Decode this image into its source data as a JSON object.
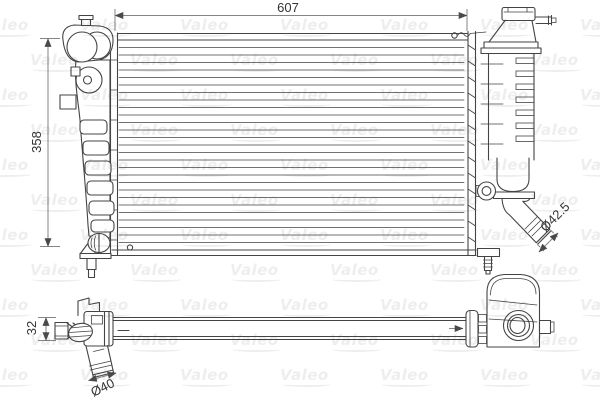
{
  "watermark": {
    "text": "Valeo"
  },
  "front_view": {
    "dimensions": {
      "width": {
        "label": "607"
      },
      "height": {
        "label": "358"
      },
      "outlet_diameter": {
        "label": "Ø42.5"
      }
    }
  },
  "bottom_view": {
    "dimensions": {
      "depth": {
        "label": "32"
      },
      "pipe_diameter": {
        "label": "Ø40"
      }
    }
  },
  "colors": {
    "background": "#ffffff",
    "line": "#444444",
    "dim_line": "#858585",
    "dim_arrow": "#4a4a4a",
    "dim_text": "#333333",
    "watermark": "rgba(70,70,70,0.09)"
  }
}
